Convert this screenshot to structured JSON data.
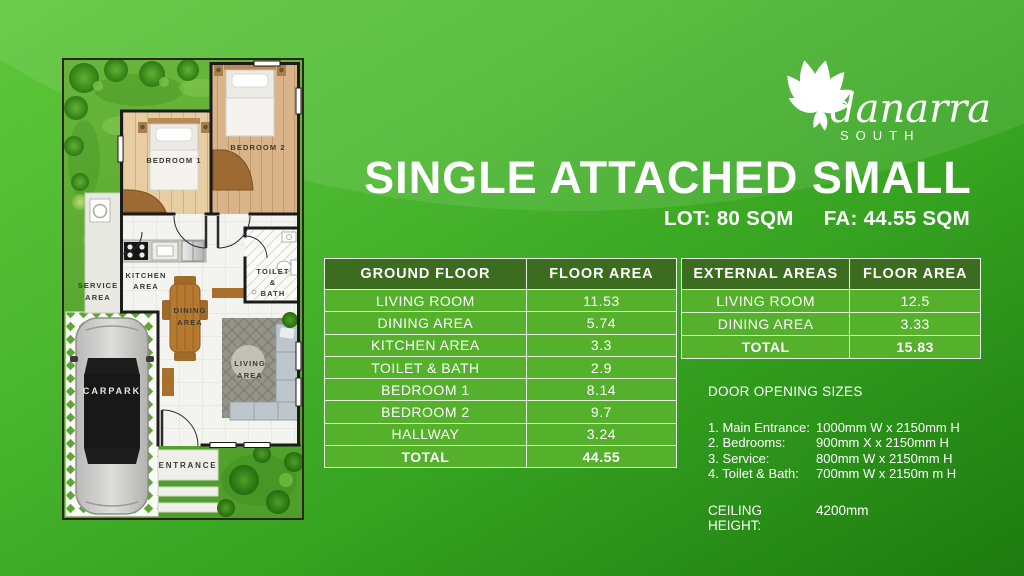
{
  "logo": {
    "name": "danarra",
    "subtitle": "SOUTH"
  },
  "header": {
    "title": "SINGLE ATTACHED SMALL",
    "lot": "LOT: 80 SQM",
    "fa": "FA: 44.55 SQM"
  },
  "ground_floor_table": {
    "headers": [
      "GROUND FLOOR",
      "FLOOR AREA"
    ],
    "rows": [
      [
        "LIVING ROOM",
        "11.53"
      ],
      [
        "DINING AREA",
        "5.74"
      ],
      [
        "KITCHEN AREA",
        "3.3"
      ],
      [
        "TOILET & BATH",
        "2.9"
      ],
      [
        "BEDROOM 1",
        "8.14"
      ],
      [
        "BEDROOM 2",
        "9.7"
      ],
      [
        "HALLWAY",
        "3.24"
      ]
    ],
    "total": [
      "TOTAL",
      "44.55"
    ]
  },
  "external_table": {
    "headers": [
      "EXTERNAL AREAS",
      "FLOOR AREA"
    ],
    "rows": [
      [
        "LIVING ROOM",
        "12.5"
      ],
      [
        "DINING AREA",
        "3.33"
      ]
    ],
    "total": [
      "TOTAL",
      "15.83"
    ]
  },
  "door_sizes": {
    "title": "DOOR OPENING SIZES",
    "items": [
      {
        "label": "1. Main Entrance:",
        "value": "1000mm W x 2150mm H"
      },
      {
        "label": "2. Bedrooms:",
        "value": "900mm X x 2150mm H"
      },
      {
        "label": "3. Service:",
        "value": "800mm W x 2150mm H"
      },
      {
        "label": "4. Toilet & Bath:",
        "value": "700mm W x 2150m m H"
      }
    ],
    "ceiling_label": "CEILING HEIGHT:",
    "ceiling_value": "4200mm"
  },
  "floor_plan": {
    "labels": {
      "bedroom1": "BEDROOM 1",
      "bedroom2": "BEDROOM 2",
      "kitchen": [
        "KITCHEN",
        "AREA"
      ],
      "service": [
        "SERVICE",
        "AREA"
      ],
      "dining": [
        "DINING",
        "AREA"
      ],
      "toilet": [
        "TOILET",
        "&",
        "BATH"
      ],
      "living": [
        "LIVING",
        "AREA"
      ],
      "carpark": "CARPARK",
      "entrance": "ENTRANCE"
    }
  },
  "colors": {
    "background_top": "#5ec63a",
    "background_bottom": "#1d7a0f",
    "table_header_green": "#3c6c1f",
    "table_row_green": "#55b12c",
    "text": "#ffffff"
  }
}
